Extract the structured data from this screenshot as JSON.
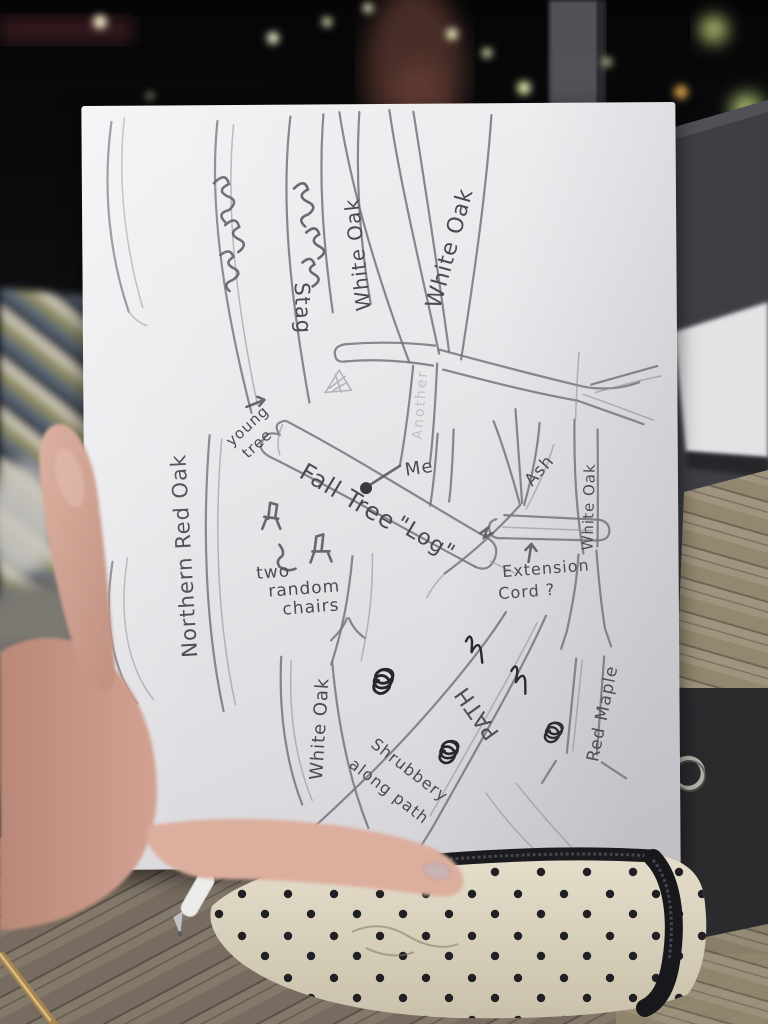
{
  "colors": {
    "paper": "#e9e8eb",
    "pencil": "#74747c",
    "ink_dark": "#26262c",
    "case": "#d8d0bc",
    "skin": "#d2a292"
  },
  "photo": {
    "paper_map": {
      "trees": {
        "stag": "Stag",
        "white_oak_a": "White Oak",
        "white_oak_b": "White Oak",
        "another_faint": "Another",
        "northern_red_oak": "Northern Red Oak",
        "ash": "Ash",
        "white_oak_right": "White Oak",
        "white_oak_bottom": "White Oak",
        "red_maple": "Red Maple"
      },
      "annotations": {
        "young_tree_line1": "young",
        "young_tree_line2": "tree",
        "me": "Me",
        "fall_tree": "Fall Tree",
        "log": "\"Log\"",
        "extension_line1": "Extension",
        "extension_line2": "Cord ?",
        "chairs_line1": "two",
        "chairs_line2": "random",
        "chairs_line3": "chairs",
        "path": "PATH",
        "shrubbery_line1": "Shrubbery",
        "shrubbery_line2": "along path"
      }
    }
  }
}
